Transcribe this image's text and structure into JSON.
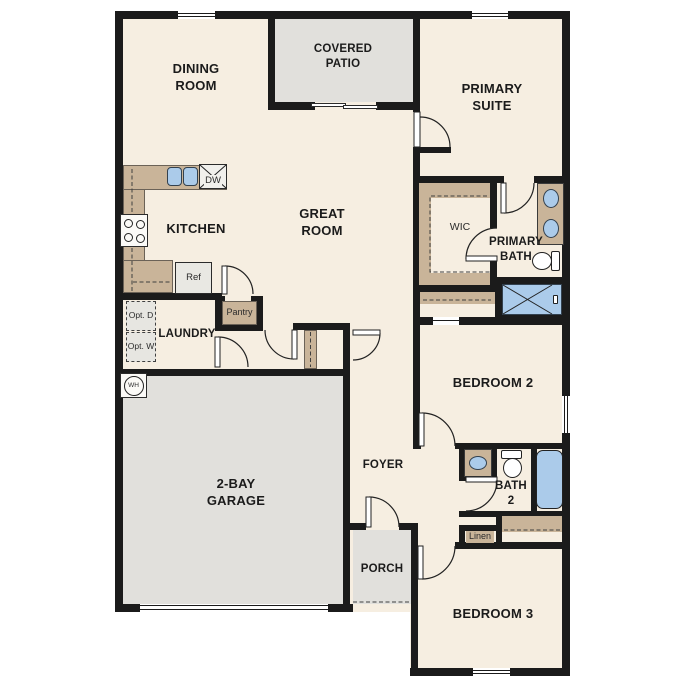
{
  "plan": {
    "rooms": {
      "dining": "DINING ROOM",
      "patio": "COVERED PATIO",
      "primary_suite": "PRIMARY SUITE",
      "kitchen": "KITCHEN",
      "great_room": "GREAT ROOM",
      "wic": "WIC",
      "primary_bath": "PRIMARY BATH",
      "laundry": "LAUNDRY",
      "bedroom2": "BEDROOM 2",
      "foyer": "FOYER",
      "bath2": "BATH 2",
      "garage": "2-BAY GARAGE",
      "porch": "PORCH",
      "bedroom3": "BEDROOM 3"
    },
    "fixtures": {
      "dishwasher": "DW",
      "refrigerator": "Ref",
      "pantry": "Pantry",
      "opt_dryer": "Opt. D",
      "opt_washer": "Opt. W",
      "water_heater": "WH",
      "linen": "Linen"
    },
    "colors": {
      "floor": "#f6eee1",
      "hardscape": "#e1e0dc",
      "wall": "#1b1b1b",
      "cabinetry": "#c9b499",
      "fixture_blue": "#abcbea"
    }
  }
}
